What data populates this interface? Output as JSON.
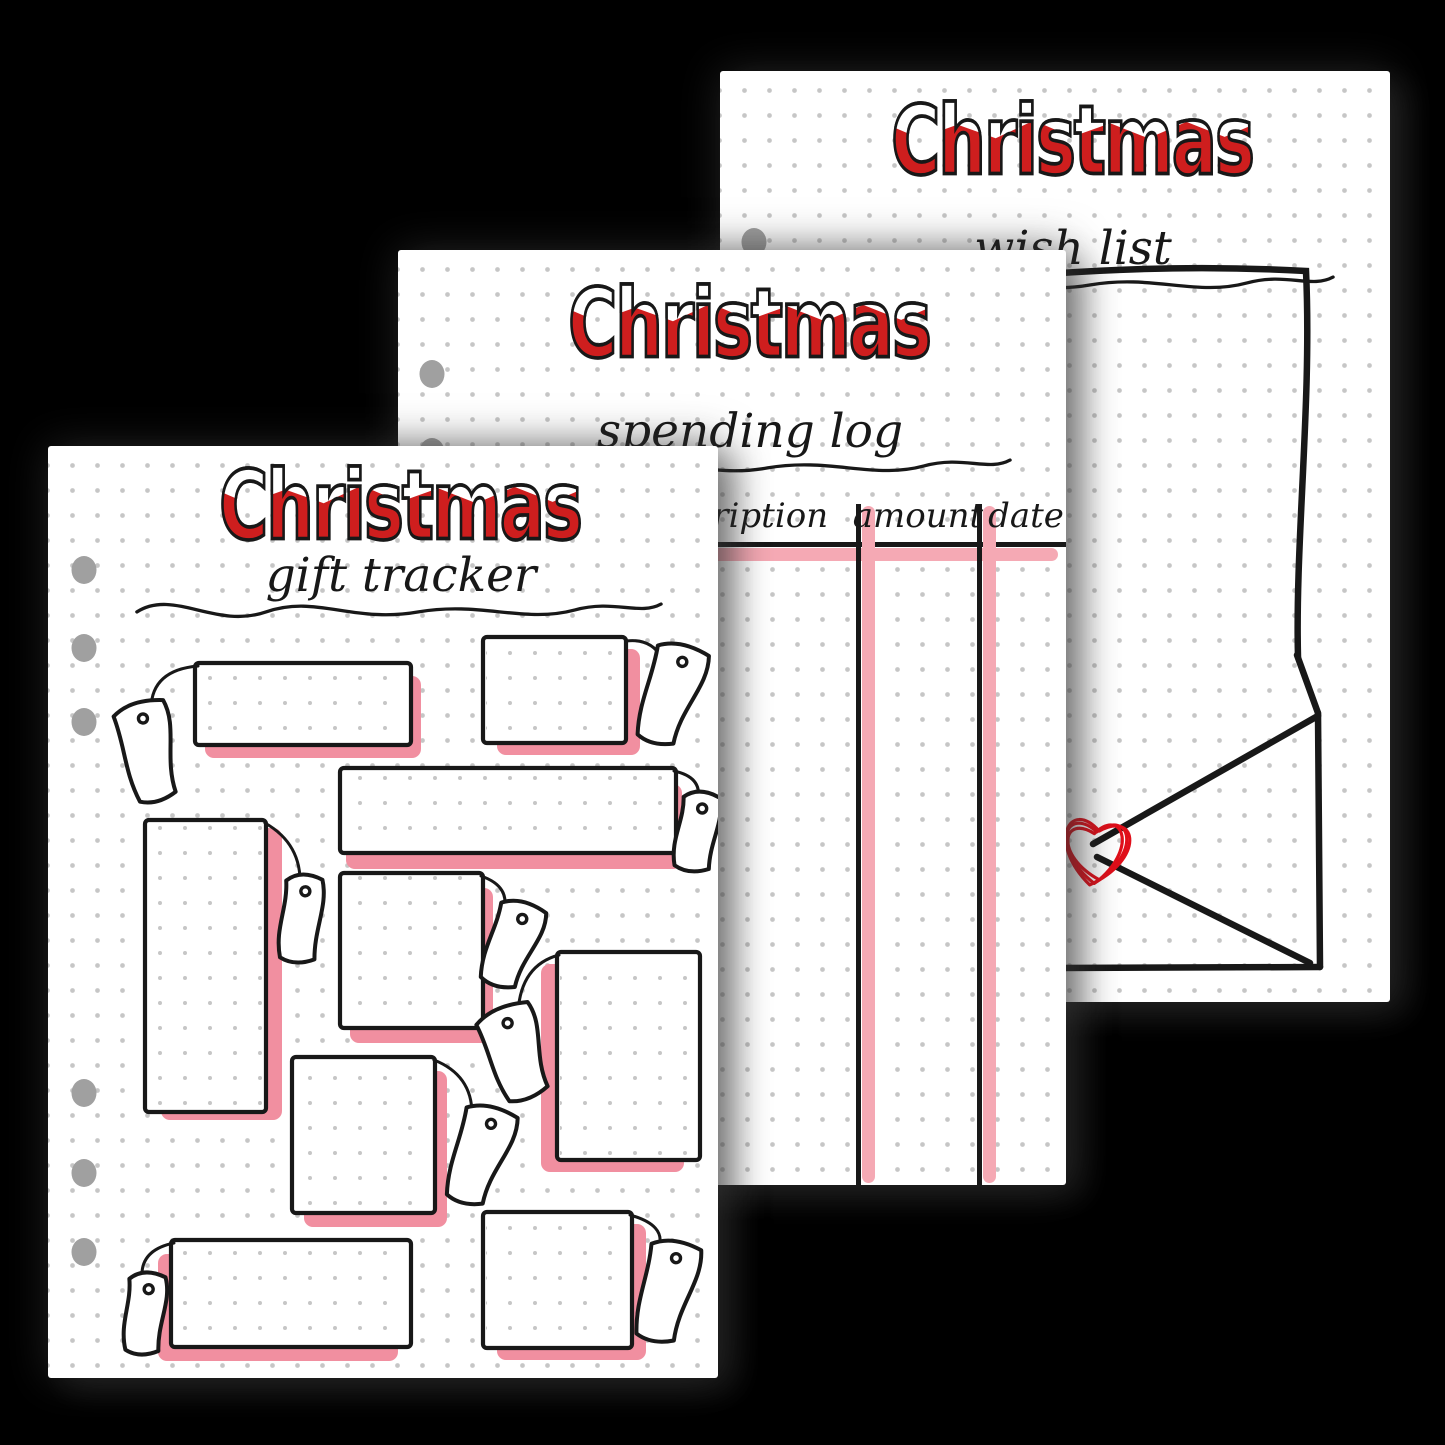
{
  "scene": {
    "background": "#000000"
  },
  "colors": {
    "page": "#ffffff",
    "ink": "#181818",
    "red": "#ce1e1e",
    "snow": "#ffffff",
    "pink_shadow": "#f18fa0",
    "pink_highlight": "#f5a9b4",
    "hole": "#a0a0a0",
    "dot": "#c6c6c6",
    "heart_red": "#e00f1a"
  },
  "pages": {
    "wish_list": {
      "name": "Christmas wish list page",
      "title": "Christmas",
      "subtitle": "wish list",
      "rect": {
        "x": 720,
        "y": 71,
        "w": 670,
        "h": 931
      },
      "holes": [
        {
          "x": 34,
          "y": 171
        }
      ],
      "letter_path": "M326,203 Q462,193 586,200 C592,330 575,470 578,586",
      "envelope_lines": [
        [
          577,
          584,
          598,
          642
        ],
        [
          598,
          642,
          600,
          896
        ],
        [
          338,
          897,
          600,
          896
        ],
        [
          373,
          773,
          596,
          646
        ],
        [
          377,
          786,
          590,
          892
        ]
      ],
      "heart": {
        "cx": 376,
        "cy": 778,
        "size": 86
      }
    },
    "spending_log": {
      "name": "Christmas spending log page",
      "title": "Christmas",
      "subtitle": "spending log",
      "rect": {
        "x": 398,
        "y": 250,
        "w": 668,
        "h": 935
      },
      "holes": [
        {
          "x": 34,
          "y": 124
        },
        {
          "x": 34,
          "y": 202
        }
      ],
      "table": {
        "headers": [
          {
            "label": "description",
            "cx": 333
          },
          {
            "label": "amount",
            "cx": 520
          },
          {
            "label": "date",
            "cx": 628
          }
        ],
        "header_top": 246,
        "hline_y": 292,
        "vlines": [
          458,
          579
        ],
        "lines_top": 254,
        "lines_bottom": 935
      }
    },
    "gift_tracker": {
      "name": "Christmas gift tracker page",
      "title": "Christmas",
      "subtitle": "gift tracker",
      "rect": {
        "x": 48,
        "y": 446,
        "w": 670,
        "h": 932
      },
      "holes": [
        {
          "x": 36,
          "y": 124
        },
        {
          "x": 36,
          "y": 202
        },
        {
          "x": 36,
          "y": 276
        },
        {
          "x": 36,
          "y": 647
        },
        {
          "x": 36,
          "y": 727
        },
        {
          "x": 36,
          "y": 806
        }
      ],
      "boxes": [
        {
          "x": 147,
          "y": 217,
          "w": 216,
          "h": 82,
          "sdx": 10,
          "sdy": 13,
          "tag": {
            "cx": 101,
            "cy": 305,
            "w": 58,
            "h": 98,
            "rot": -14,
            "bend": 16
          },
          "string": [
            150,
            220,
            104,
            224,
            103,
            262
          ]
        },
        {
          "x": 435,
          "y": 191,
          "w": 143,
          "h": 106,
          "sdx": 14,
          "sdy": 12,
          "tag": {
            "cx": 623,
            "cy": 248,
            "w": 58,
            "h": 100,
            "rot": 16,
            "bend": 16
          },
          "string": [
            578,
            195,
            603,
            192,
            614,
            212
          ]
        },
        {
          "x": 292,
          "y": 322,
          "w": 336,
          "h": 85,
          "sdx": 6,
          "sdy": 16,
          "tag": {
            "cx": 649,
            "cy": 385,
            "w": 42,
            "h": 78,
            "rot": 8,
            "bend": 7
          },
          "string": [
            626,
            325,
            654,
            331,
            650,
            353
          ]
        },
        {
          "x": 97,
          "y": 374,
          "w": 121,
          "h": 292,
          "sdx": 16,
          "sdy": 8,
          "tag": {
            "cx": 253,
            "cy": 472,
            "w": 42,
            "h": 86,
            "rot": 5,
            "bend": 7
          },
          "string": [
            217,
            377,
            254,
            398,
            252,
            440
          ]
        },
        {
          "x": 292,
          "y": 427,
          "w": 143,
          "h": 155,
          "sdx": 10,
          "sdy": 15,
          "tag": {
            "cx": 464,
            "cy": 498,
            "w": 52,
            "h": 86,
            "rot": 18,
            "bend": 13
          },
          "string": [
            433,
            430,
            462,
            440,
            456,
            464
          ]
        },
        {
          "x": 244,
          "y": 611,
          "w": 143,
          "h": 156,
          "sdx": 12,
          "sdy": 14,
          "tag": {
            "cx": 432,
            "cy": 709,
            "w": 58,
            "h": 98,
            "rot": 16,
            "bend": 16
          },
          "string": [
            386,
            614,
            424,
            629,
            424,
            668
          ]
        },
        {
          "x": 509,
          "y": 506,
          "w": 143,
          "h": 208,
          "sdx": -16,
          "sdy": 12,
          "tag": {
            "cx": 468,
            "cy": 606,
            "w": 62,
            "h": 92,
            "rot": -20,
            "bend": 16
          },
          "string": [
            511,
            509,
            473,
            519,
            470,
            566
          ]
        },
        {
          "x": 123,
          "y": 794,
          "w": 240,
          "h": 107,
          "sdx": -13,
          "sdy": 14,
          "tag": {
            "cx": 97,
            "cy": 867,
            "w": 42,
            "h": 80,
            "rot": 4,
            "bend": 8
          },
          "string": [
            126,
            797,
            92,
            804,
            94,
            832
          ]
        },
        {
          "x": 435,
          "y": 766,
          "w": 149,
          "h": 136,
          "sdx": 14,
          "sdy": 12,
          "tag": {
            "cx": 619,
            "cy": 845,
            "w": 56,
            "h": 100,
            "rot": 12,
            "bend": 14
          },
          "string": [
            582,
            769,
            618,
            779,
            611,
            801
          ]
        }
      ]
    }
  }
}
